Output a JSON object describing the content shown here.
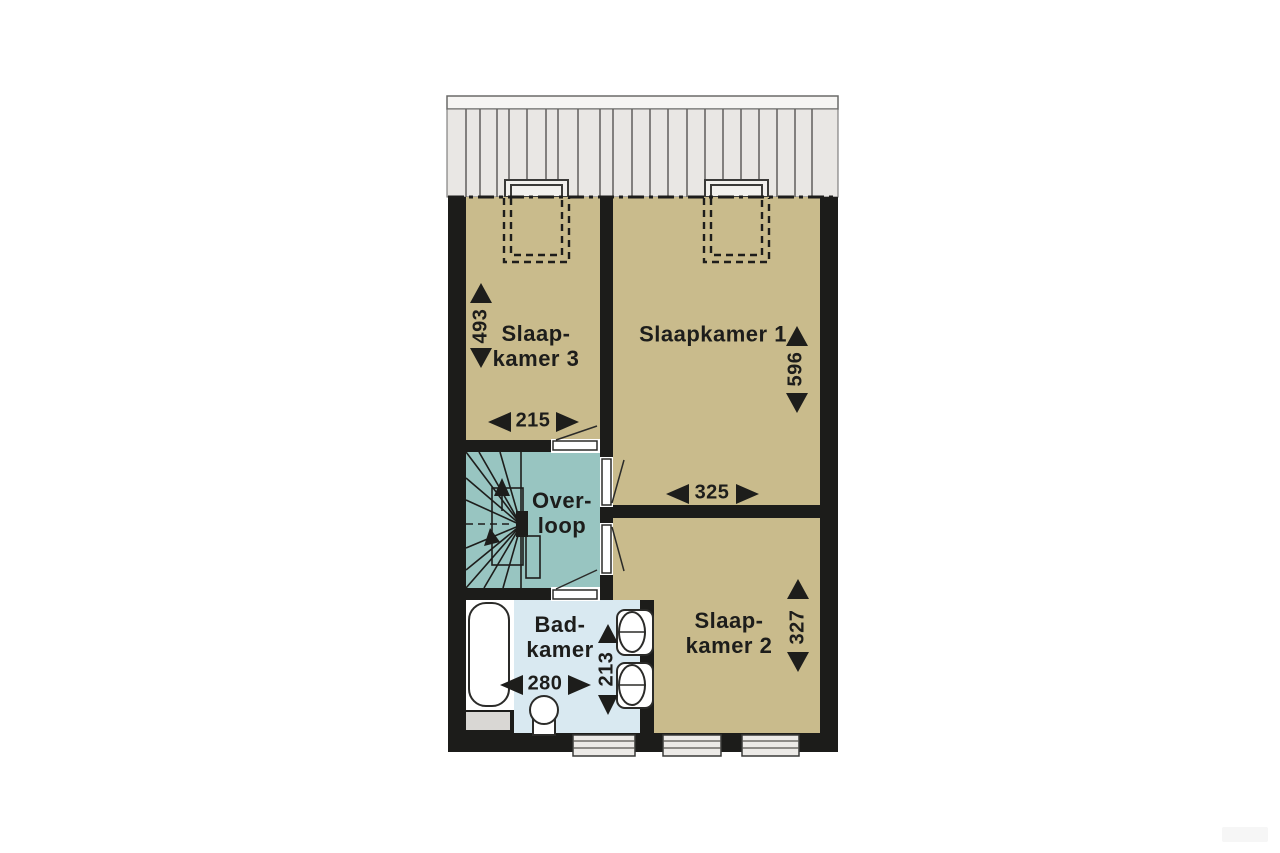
{
  "rooms": {
    "slaapkamer1": {
      "label": "Slaapkamer 1",
      "width": "325",
      "depth": "596"
    },
    "slaapkamer2": {
      "label_line1": "Slaap-",
      "label_line2": "kamer 2",
      "depth": "327"
    },
    "slaapkamer3": {
      "label_line1": "Slaap-",
      "label_line2": "kamer 3",
      "width": "215",
      "depth": "493"
    },
    "overloop": {
      "label_line1": "Over-",
      "label_line2": "loop"
    },
    "badkamer": {
      "label_line1": "Bad-",
      "label_line2": "kamer",
      "width": "280",
      "depth": "213"
    }
  },
  "colors": {
    "bedroom_floor": "#c9bb8c",
    "landing_floor": "#98c5c1",
    "bathroom_floor": "#d9e9f1",
    "wall": "#1c1c1a",
    "roof": "#e9e7e4",
    "roof_line": "#5f5e5c",
    "window_fill": "#eceae7",
    "shelf_fill": "#d9d7d4",
    "fixture_outline": "#2b2b29",
    "text": "#1d1d1b"
  }
}
